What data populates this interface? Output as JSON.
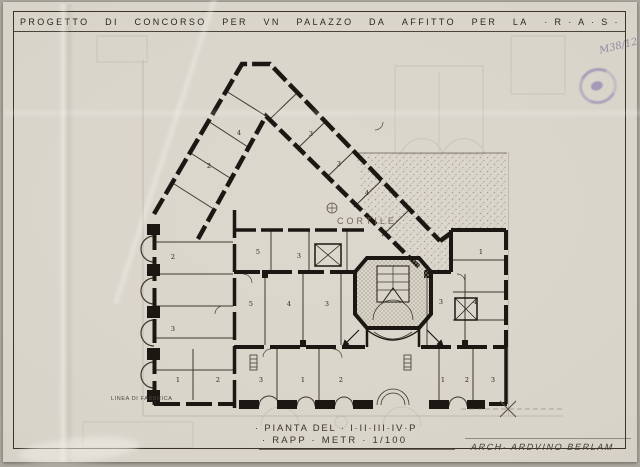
{
  "title": {
    "words": [
      "PROGETTO",
      "DI",
      "CONCORSO",
      "PER",
      "VN",
      "PALAZZO",
      "DA",
      "AFFITTO",
      "PER",
      "LA",
      "· R · A · S ·"
    ]
  },
  "annotations": {
    "pencil_note": "M38/12",
    "stamp_name": "round-ink-stamp",
    "courtyard_label": "CORTILE",
    "building_line_label": "LINEA DI FABBRICA"
  },
  "captions": {
    "line1": "· PIANTA DEL · I·II·III·IV·P",
    "line2": "· RAPP · METR · 1/100",
    "signature": "ARCH· ARDVINO BERLAM"
  },
  "colors": {
    "paper": "#d8d4ca",
    "ink": "#1b1712",
    "stamp_ink": "#7a6fae",
    "pencil": "#857b95",
    "faded_ink": "#6e6452"
  },
  "plan": {
    "room_numbers": [
      {
        "x": 206,
        "y": 166,
        "label": "2"
      },
      {
        "x": 236,
        "y": 133,
        "label": "4"
      },
      {
        "x": 308,
        "y": 134,
        "label": "3"
      },
      {
        "x": 336,
        "y": 164,
        "label": "3"
      },
      {
        "x": 364,
        "y": 193,
        "label": "4"
      },
      {
        "x": 170,
        "y": 257,
        "label": "2"
      },
      {
        "x": 170,
        "y": 329,
        "label": "3"
      },
      {
        "x": 255,
        "y": 252,
        "label": "5"
      },
      {
        "x": 296,
        "y": 256,
        "label": "3"
      },
      {
        "x": 248,
        "y": 304,
        "label": "5"
      },
      {
        "x": 286,
        "y": 304,
        "label": "4"
      },
      {
        "x": 324,
        "y": 304,
        "label": "3"
      },
      {
        "x": 438,
        "y": 302,
        "label": "3"
      },
      {
        "x": 472,
        "y": 302,
        "label": "4"
      },
      {
        "x": 478,
        "y": 252,
        "label": "1"
      },
      {
        "x": 175,
        "y": 380,
        "label": "1"
      },
      {
        "x": 215,
        "y": 380,
        "label": "2"
      },
      {
        "x": 258,
        "y": 380,
        "label": "3"
      },
      {
        "x": 300,
        "y": 380,
        "label": "1"
      },
      {
        "x": 338,
        "y": 380,
        "label": "2"
      },
      {
        "x": 440,
        "y": 380,
        "label": "1"
      },
      {
        "x": 464,
        "y": 380,
        "label": "2"
      },
      {
        "x": 490,
        "y": 380,
        "label": "3"
      }
    ]
  }
}
